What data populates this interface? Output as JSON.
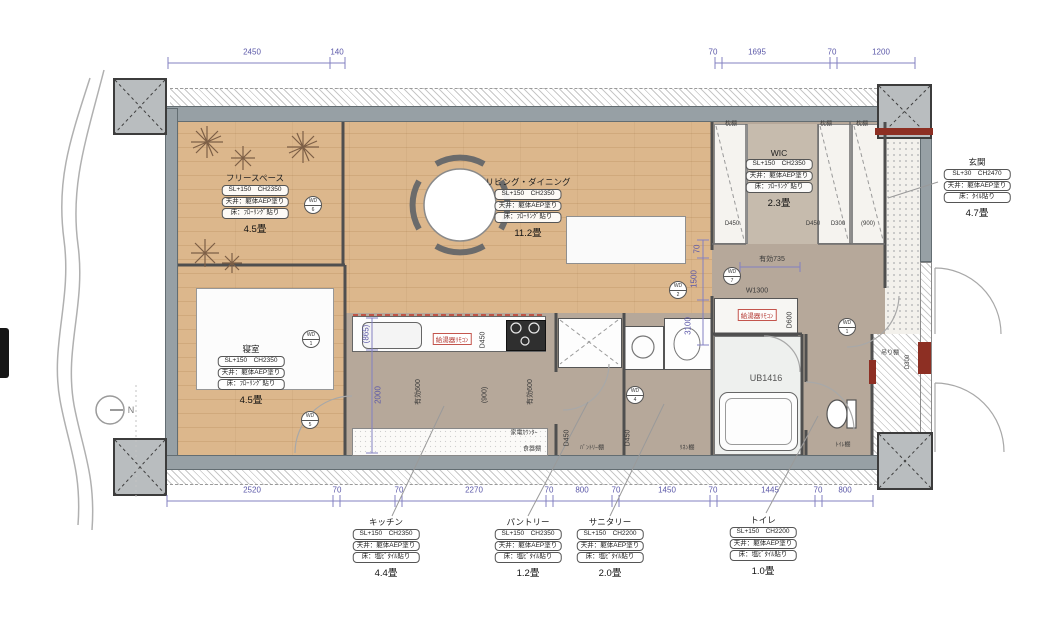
{
  "rooms": {
    "free_space": {
      "name": "フリースペース",
      "area": "4.5畳",
      "spec": [
        "SL+150　CH2350",
        "天井：躯体AEP塗り",
        "床：ﾌﾛｰﾘﾝｸﾞ貼り"
      ]
    },
    "living": {
      "name": "リビング・ダイニング",
      "area": "11.2畳",
      "spec": [
        "SL+150　CH2350",
        "天井：躯体AEP塗り",
        "床：ﾌﾛｰﾘﾝｸﾞ貼り"
      ]
    },
    "wic": {
      "name": "WIC",
      "area": "2.3畳",
      "spec": [
        "SL+150　CH2350",
        "天井：躯体AEP塗り",
        "床：ﾌﾛｰﾘﾝｸﾞ貼り"
      ]
    },
    "bedroom": {
      "name": "寝室",
      "area": "4.5畳",
      "spec": [
        "SL+150　CH2350",
        "天井：躯体AEP塗り",
        "床：ﾌﾛｰﾘﾝｸﾞ貼り"
      ]
    },
    "entrance": {
      "name": "玄関",
      "area": "4.7畳",
      "spec": [
        "SL+30　CH2470",
        "天井：躯体AEP塗り",
        "床：ﾀｲﾙ貼り"
      ]
    },
    "kitchen": {
      "name": "キッチン",
      "area": "4.4畳",
      "spec": [
        "SL+150　CH2350",
        "天井：躯体AEP塗り",
        "床：塩ﾋﾞﾀｲﾙ貼り"
      ]
    },
    "pantry": {
      "name": "パントリー",
      "area": "1.2畳",
      "spec": [
        "SL+150　CH2350",
        "天井：躯体AEP塗り",
        "床：塩ﾋﾞﾀｲﾙ貼り"
      ]
    },
    "sanitary": {
      "name": "サニタリー",
      "area": "2.0畳",
      "spec": [
        "SL+150　CH2200",
        "天井：躯体AEP塗り",
        "床：塩ﾋﾞﾀｲﾙ貼り"
      ]
    },
    "toilet": {
      "name": "トイレ",
      "area": "1.0畳",
      "spec": [
        "SL+150　CH2200",
        "天井：躯体AEP塗り",
        "床：塩ﾋﾞﾀｲﾙ貼り"
      ]
    }
  },
  "dims": {
    "top": [
      "2450",
      "140",
      "70",
      "1695",
      "70",
      "1200"
    ],
    "bottom": [
      "2520",
      "70",
      "70",
      "2270",
      "70",
      "800",
      "70",
      "1450",
      "70",
      "1445",
      "70",
      "800"
    ],
    "left_865": "(865)",
    "left_2000": "2000",
    "right_70": "70",
    "right_1500": "1500",
    "right_3100": "3100",
    "yuko735": "有効735",
    "w1300": "W1300",
    "d600": "D600",
    "yuko600a": "有効600",
    "p900a": "(900)",
    "yuko600b": "有効600",
    "d450_k": "D450",
    "d450_p": "D450",
    "d450_s": "D450",
    "wic_d450a": "D450",
    "wic_d450b": "D450",
    "wic_d300": "D300",
    "wic_900": "(900)",
    "d300_hang": "D300"
  },
  "labels": {
    "makura1": "枕棚",
    "makura2": "枕棚",
    "makura3": "枕棚",
    "kaden": "家電ｶｳﾝﾀｰ",
    "shokki": "食器棚",
    "pantry_shelf": "ﾊﾟﾝﾄﾘｰ棚",
    "linen_shelf": "ﾘﾈﾝ棚",
    "toilet_shelf": "ﾄｲﾚ棚",
    "hang_shelf": "吊り棚",
    "ub": "UB1416",
    "remote1": "給湯器ﾘﾓｺﾝ",
    "remote2": "給湯器ﾘﾓｺﾝ",
    "north": "N"
  },
  "markers": [
    {
      "t": "WD",
      "n": "6"
    },
    {
      "t": "WD",
      "n": "1"
    },
    {
      "t": "WD",
      "n": "5"
    },
    {
      "t": "WD",
      "n": "2"
    },
    {
      "t": "WD",
      "n": "4"
    },
    {
      "t": "WD",
      "n": "7"
    },
    {
      "t": "WD",
      "n": "1"
    }
  ],
  "colors": {
    "wood": "#d8b487",
    "hall": "#b6a89a",
    "wall": "#97a0a5",
    "dim": "#5b58a8",
    "accent_red": "#8d2f23"
  }
}
